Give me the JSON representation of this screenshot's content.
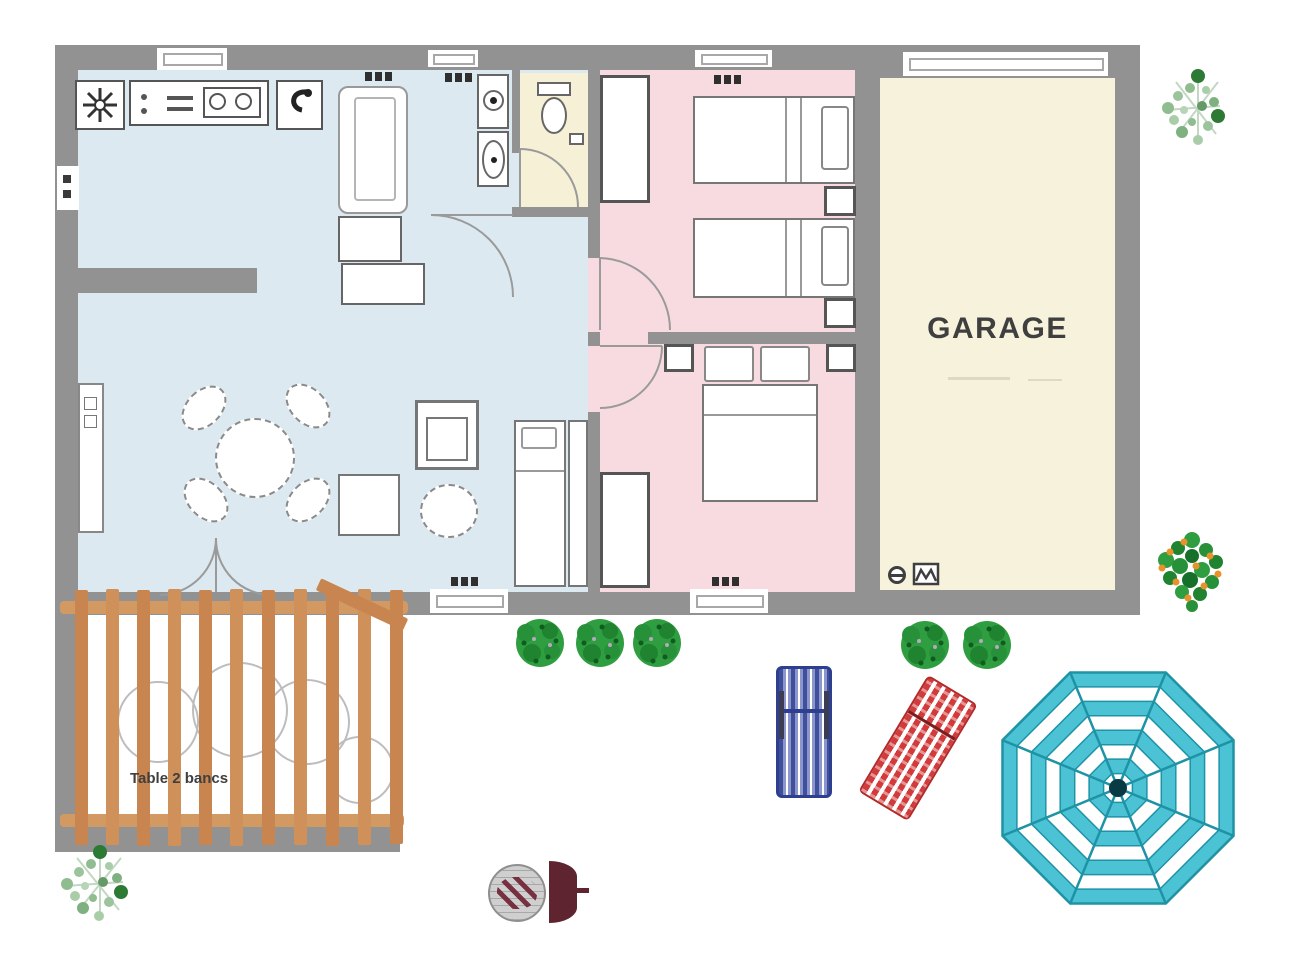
{
  "floorplan": {
    "garage_label": "GARAGE",
    "pergola_label": "Table 2 bancs"
  },
  "colors": {
    "wall": "#929292",
    "living": "#dce9f0",
    "bedroom": "#f8dbe0",
    "service": "#f5f0d6",
    "garage": "#f7f2dc",
    "wood": "#c8854f",
    "beam": "#d29a62",
    "bush": "#2f9e41",
    "parasol": "#4cc3d5",
    "parasol-line": "#1f93a6",
    "lounger-blue": "#44549f",
    "lounger-red": "#d23b3b",
    "bbq": "#5e2430",
    "outline": "#767676",
    "label": "#3f3f3f"
  },
  "icons": {
    "stove-icon": "burst / hob symbol",
    "kitchen-sink-icon": "double basin with taps",
    "fridge-icon": "dark hook glyph",
    "washer-icon": "square with circle and dot",
    "laundry-tub-icon": "square with oval and dot",
    "toilet-icon": "tank and bowl",
    "water-heater-icon": "circle with band",
    "electric-panel-icon": "box with zigzag",
    "bbq-icon": "kettle grill top view",
    "parasol-icon": "striped octagon umbrella",
    "bush-icon": "round green cluster",
    "plant-icon": "sparse light-green branches",
    "orange-tree-icon": "green cluster with orange fruit"
  }
}
